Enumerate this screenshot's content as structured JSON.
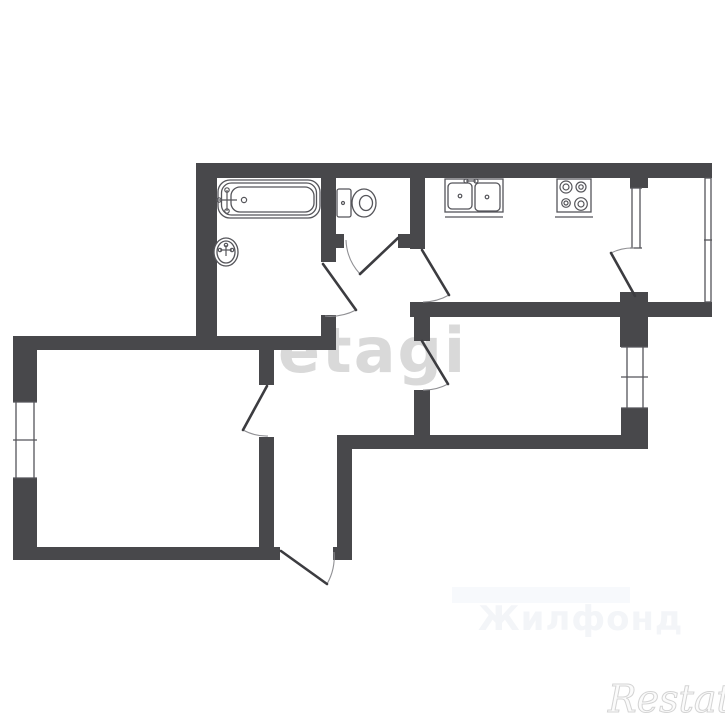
{
  "watermarks": {
    "center": "etagi",
    "bottom_faint": "Жилфонд",
    "logo": "Restate"
  },
  "colors": {
    "background": "#ffffff",
    "wall": "#48484b",
    "line": "#55555a",
    "leaf": "#3c3c40",
    "arc": "#909094",
    "watermark_center": "#d9d9d9",
    "watermark_faint": "#f3f5f8",
    "watermark_band": "#f7f9fc",
    "logo_fill": "#fbfbfb"
  },
  "plan": {
    "walls": [
      [
        196,
        163,
        516,
        15,
        "top-wall"
      ],
      [
        196,
        163,
        21,
        187,
        "bathroom-left-wall"
      ],
      [
        321,
        178,
        15,
        84,
        "bathroom-wc-wall"
      ],
      [
        321,
        315,
        15,
        21,
        "bathroom-right-wall-lower"
      ],
      [
        321,
        234,
        23,
        14,
        "wc-bottom-wall-left"
      ],
      [
        398,
        234,
        12,
        14,
        "wc-bottom-wall-right"
      ],
      [
        410,
        178,
        15,
        71,
        "wc-kitchen-wall"
      ],
      [
        410,
        302,
        302,
        15,
        "kitchen-bottom-wall"
      ],
      [
        620,
        292,
        28,
        55,
        "balcony-pillar"
      ],
      [
        630,
        178,
        18,
        10,
        "kitchen-window-pillar"
      ],
      [
        13,
        336,
        323,
        14,
        "mid-wall"
      ],
      [
        13,
        336,
        24,
        66,
        "room1-left-wall-upper"
      ],
      [
        13,
        478,
        24,
        82,
        "room1-left-wall-lower"
      ],
      [
        13,
        547,
        267,
        13,
        "room1-bottom-wall"
      ],
      [
        333,
        547,
        19,
        13,
        "entry-wall-block"
      ],
      [
        259,
        350,
        15,
        35,
        "room1-right-wall-upper"
      ],
      [
        259,
        437,
        15,
        110,
        "room1-right-wall-lower"
      ],
      [
        337,
        449,
        15,
        98,
        "hall-right-wall"
      ],
      [
        337,
        435,
        311,
        14,
        "room2-bottom-wall"
      ],
      [
        414,
        317,
        16,
        24,
        "hall-room2-wall-upper"
      ],
      [
        414,
        390,
        16,
        45,
        "hall-room2-wall-lower"
      ],
      [
        621,
        408,
        27,
        27,
        "room2-right-wall-lower"
      ]
    ],
    "windows": [
      {
        "name": "room1-window",
        "lines": [
          [
            16,
            402,
            16,
            478
          ],
          [
            34,
            402,
            34,
            478
          ],
          [
            13,
            402,
            37,
            402
          ],
          [
            13,
            478,
            37,
            478
          ],
          [
            13,
            440,
            37,
            440
          ]
        ]
      },
      {
        "name": "room2-window",
        "lines": [
          [
            627,
            347,
            627,
            408
          ],
          [
            643,
            347,
            643,
            408
          ],
          [
            621,
            347,
            648,
            347
          ],
          [
            621,
            408,
            648,
            408
          ],
          [
            621,
            377,
            648,
            377
          ]
        ]
      },
      {
        "name": "kitchen-window",
        "lines": [
          [
            632,
            188,
            632,
            248
          ],
          [
            640,
            188,
            640,
            248
          ],
          [
            630,
            188,
            642,
            188
          ],
          [
            630,
            248,
            642,
            248
          ]
        ]
      },
      {
        "name": "balcony-glazing",
        "lines": [
          [
            705,
            178,
            705,
            302
          ],
          [
            711,
            178,
            711,
            302
          ],
          [
            704,
            240,
            712,
            240
          ],
          [
            705,
            178,
            711,
            178
          ],
          [
            705,
            302,
            711,
            302
          ]
        ]
      }
    ],
    "doors": [
      {
        "name": "bathroom-door",
        "leaf": "M323,264 L356,310",
        "arc": "M356,310 A56,56 0 0 1 325,316"
      },
      {
        "name": "wc-door",
        "leaf": "M398,238 L360,274",
        "arc": "M346,240 A53,53 0 0 0 360,274"
      },
      {
        "name": "kitchen-door",
        "leaf": "M422,250 L449,295",
        "arc": "M449,295 A53,53 0 0 1 423,302"
      },
      {
        "name": "balcony-door",
        "leaf": "M635,296 L611,253",
        "arc": "M611,253 A49,49 0 0 1 634,248"
      },
      {
        "name": "room1-door",
        "leaf": "M267,386 L243,430",
        "arc": "M243,430 A50,50 0 0 0 268,436"
      },
      {
        "name": "room2-door",
        "leaf": "M422,341 L448,384",
        "arc": "M448,384 A50,50 0 0 1 423,390"
      },
      {
        "name": "entrance-door",
        "leaf": "M281,551 L327,584",
        "arc": "M327,584 A55,55 0 0 0 334,552"
      }
    ],
    "fixtures": [
      {
        "name": "bathtub",
        "shapes": [
          {
            "t": "rrect",
            "x": 218,
            "y": 180,
            "w": 102,
            "h": 38,
            "r": 12,
            "f": 1
          },
          {
            "t": "rrect",
            "x": 221.5,
            "y": 183,
            "w": 95,
            "h": 32,
            "r": 10
          },
          {
            "t": "rrect",
            "x": 231,
            "y": 187,
            "w": 83,
            "h": 25,
            "r": 9
          },
          {
            "t": "line",
            "x": 227,
            "y": 190,
            "x2": 227,
            "y2": 211
          },
          {
            "t": "line",
            "x": 219,
            "y": 200,
            "x2": 237,
            "y2": 200
          },
          {
            "t": "circle",
            "x": 227,
            "y": 190,
            "r": 2.2
          },
          {
            "t": "circle",
            "x": 227,
            "y": 211,
            "r": 2.2
          },
          {
            "t": "circle",
            "x": 219,
            "y": 200,
            "r": 2.2
          },
          {
            "t": "circle",
            "x": 244,
            "y": 200,
            "r": 2.6
          }
        ]
      },
      {
        "name": "washbasin",
        "shapes": [
          {
            "t": "ellipse",
            "x": 226,
            "y": 252,
            "rx": 12,
            "ry": 14,
            "f": 1
          },
          {
            "t": "ellipse",
            "x": 226,
            "y": 252,
            "rx": 9,
            "ry": 11
          },
          {
            "t": "line",
            "x": 226,
            "y": 245,
            "x2": 226,
            "y2": 256
          },
          {
            "t": "line",
            "x": 220,
            "y": 250,
            "x2": 232,
            "y2": 250
          },
          {
            "t": "circle",
            "x": 220,
            "y": 250,
            "r": 1.7
          },
          {
            "t": "circle",
            "x": 232,
            "y": 250,
            "r": 1.7
          },
          {
            "t": "circle",
            "x": 226,
            "y": 245,
            "r": 1.7
          }
        ]
      },
      {
        "name": "toilet",
        "shapes": [
          {
            "t": "rrect",
            "x": 337,
            "y": 189,
            "w": 14,
            "h": 28,
            "r": 2,
            "f": 1
          },
          {
            "t": "circle",
            "x": 343,
            "y": 203,
            "r": 1.5
          },
          {
            "t": "ellipse",
            "x": 364,
            "y": 203,
            "rx": 12,
            "ry": 14,
            "f": 1
          },
          {
            "t": "ellipse",
            "x": 366,
            "y": 203,
            "rx": 6.5,
            "ry": 7.5
          }
        ]
      },
      {
        "name": "kitchen-sink",
        "shapes": [
          {
            "t": "rect",
            "x": 445,
            "y": 179,
            "w": 58,
            "h": 33,
            "f": 1
          },
          {
            "t": "rrect",
            "x": 448,
            "y": 183,
            "w": 24,
            "h": 26,
            "r": 4
          },
          {
            "t": "rrect",
            "x": 475,
            "y": 183,
            "w": 25,
            "h": 28,
            "r": 4
          },
          {
            "t": "circle",
            "x": 460,
            "y": 196,
            "r": 1.8
          },
          {
            "t": "circle",
            "x": 487,
            "y": 197,
            "r": 1.8
          },
          {
            "t": "line",
            "x": 445,
            "y": 217,
            "x2": 503,
            "y2": 217
          },
          {
            "t": "circle",
            "x": 466,
            "y": 181,
            "r": 2
          },
          {
            "t": "circle",
            "x": 476,
            "y": 181,
            "r": 2
          },
          {
            "t": "line",
            "x": 466,
            "y": 181,
            "x2": 476,
            "y2": 181
          }
        ]
      },
      {
        "name": "stove",
        "shapes": [
          {
            "t": "rect",
            "x": 557,
            "y": 179,
            "w": 34,
            "h": 33,
            "f": 1
          },
          {
            "t": "line",
            "x": 555,
            "y": 217,
            "x2": 593,
            "y2": 217
          },
          {
            "t": "circle",
            "x": 566,
            "y": 187,
            "r": 6
          },
          {
            "t": "circle",
            "x": 566,
            "y": 187,
            "r": 3
          },
          {
            "t": "circle",
            "x": 581,
            "y": 187,
            "r": 5
          },
          {
            "t": "circle",
            "x": 581,
            "y": 187,
            "r": 2.2
          },
          {
            "t": "circle",
            "x": 566,
            "y": 203,
            "r": 4.3
          },
          {
            "t": "circle",
            "x": 566,
            "y": 203,
            "r": 2
          },
          {
            "t": "circle",
            "x": 581,
            "y": 204,
            "r": 6.3
          },
          {
            "t": "circle",
            "x": 581,
            "y": 204,
            "r": 3
          }
        ]
      }
    ]
  }
}
